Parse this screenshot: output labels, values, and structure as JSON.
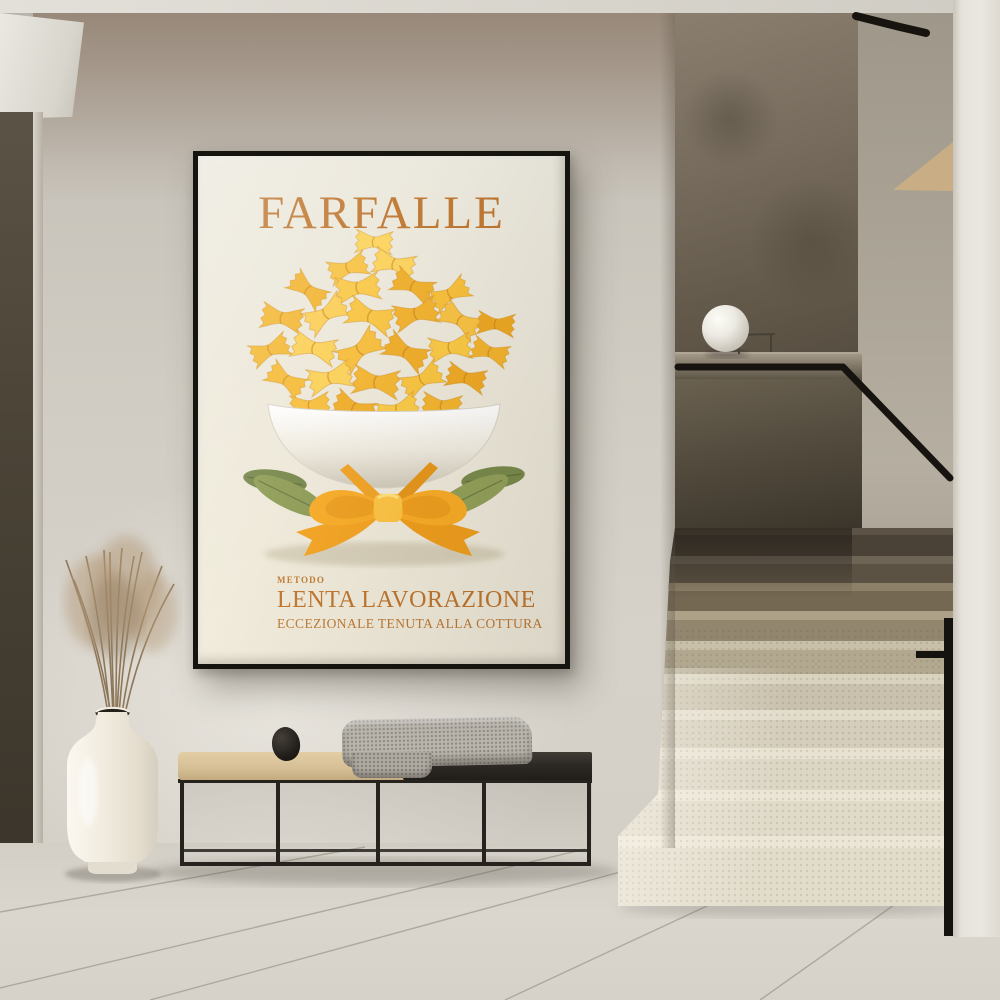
{
  "poster": {
    "title": "FARFALLE",
    "method_label": "METODO",
    "method_title": "LENTA LAVORAZIONE",
    "method_subtitle": "ECCEZIONALE TENUTA ALLA COTTURA",
    "colors": {
      "accent_text": "#bd742c",
      "background": "#efe9da",
      "frame": "#16140f",
      "pasta_yellow": "#f5bd3e",
      "pasta_deep": "#eca723",
      "ribbon_orange": "#f3a82a",
      "leaf_green": "#8a9752",
      "bowl_white": "#f6f2e8"
    }
  },
  "room": {
    "colors": {
      "wall": "#d0ccc3",
      "wall_tint_top": "#7a6553",
      "floor": "#d8d4cb",
      "ceiling": "#dbd8d1",
      "left_door": "#4a4336",
      "stair_light": "#e8e2d2",
      "stair_dark": "#5c5346",
      "alcove_wall": "#776c5d",
      "glass_balustrade": "#463f33",
      "handrail": "#17140f",
      "right_column": "#eae7e0",
      "sphere_lamp": "#f6f3ec",
      "vase": "#f1ece2",
      "dried_grass": "#ab9172",
      "bench_frame": "#26231f",
      "cushion": "#d7c096",
      "blanket": "#b9b5ad",
      "stones": "#1e1b18"
    }
  }
}
